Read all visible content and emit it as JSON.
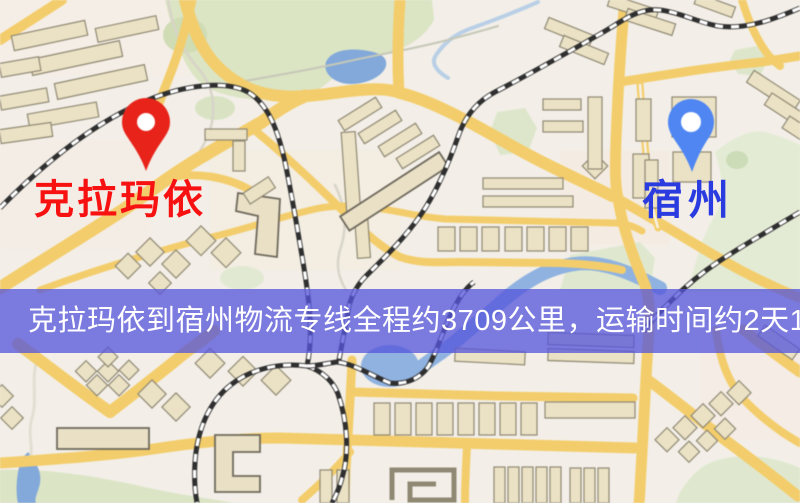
{
  "banner": {
    "text": "克拉玛依到宿州物流专线全程约3709公里，运输时间约2天13小时."
  },
  "markers": {
    "origin": {
      "label": "克拉玛依",
      "icon": "red-map-pin"
    },
    "destination": {
      "label": "宿州",
      "icon": "blue-map-pin"
    }
  },
  "colors": {
    "background": "#f3efe8",
    "road": "#f3cd6b",
    "park": "#dbe4c3",
    "water": "#82a9da",
    "building": "#ebe2c5",
    "railway": "#2f2f2f",
    "banner_bg": "rgba(85,85,220,0.76)",
    "banner_text": "#ffffff",
    "pin_red": "#e8231a",
    "pin_blue": "#4f86f2",
    "origin_label": "#f71111",
    "destination_label": "#2a3be0"
  }
}
